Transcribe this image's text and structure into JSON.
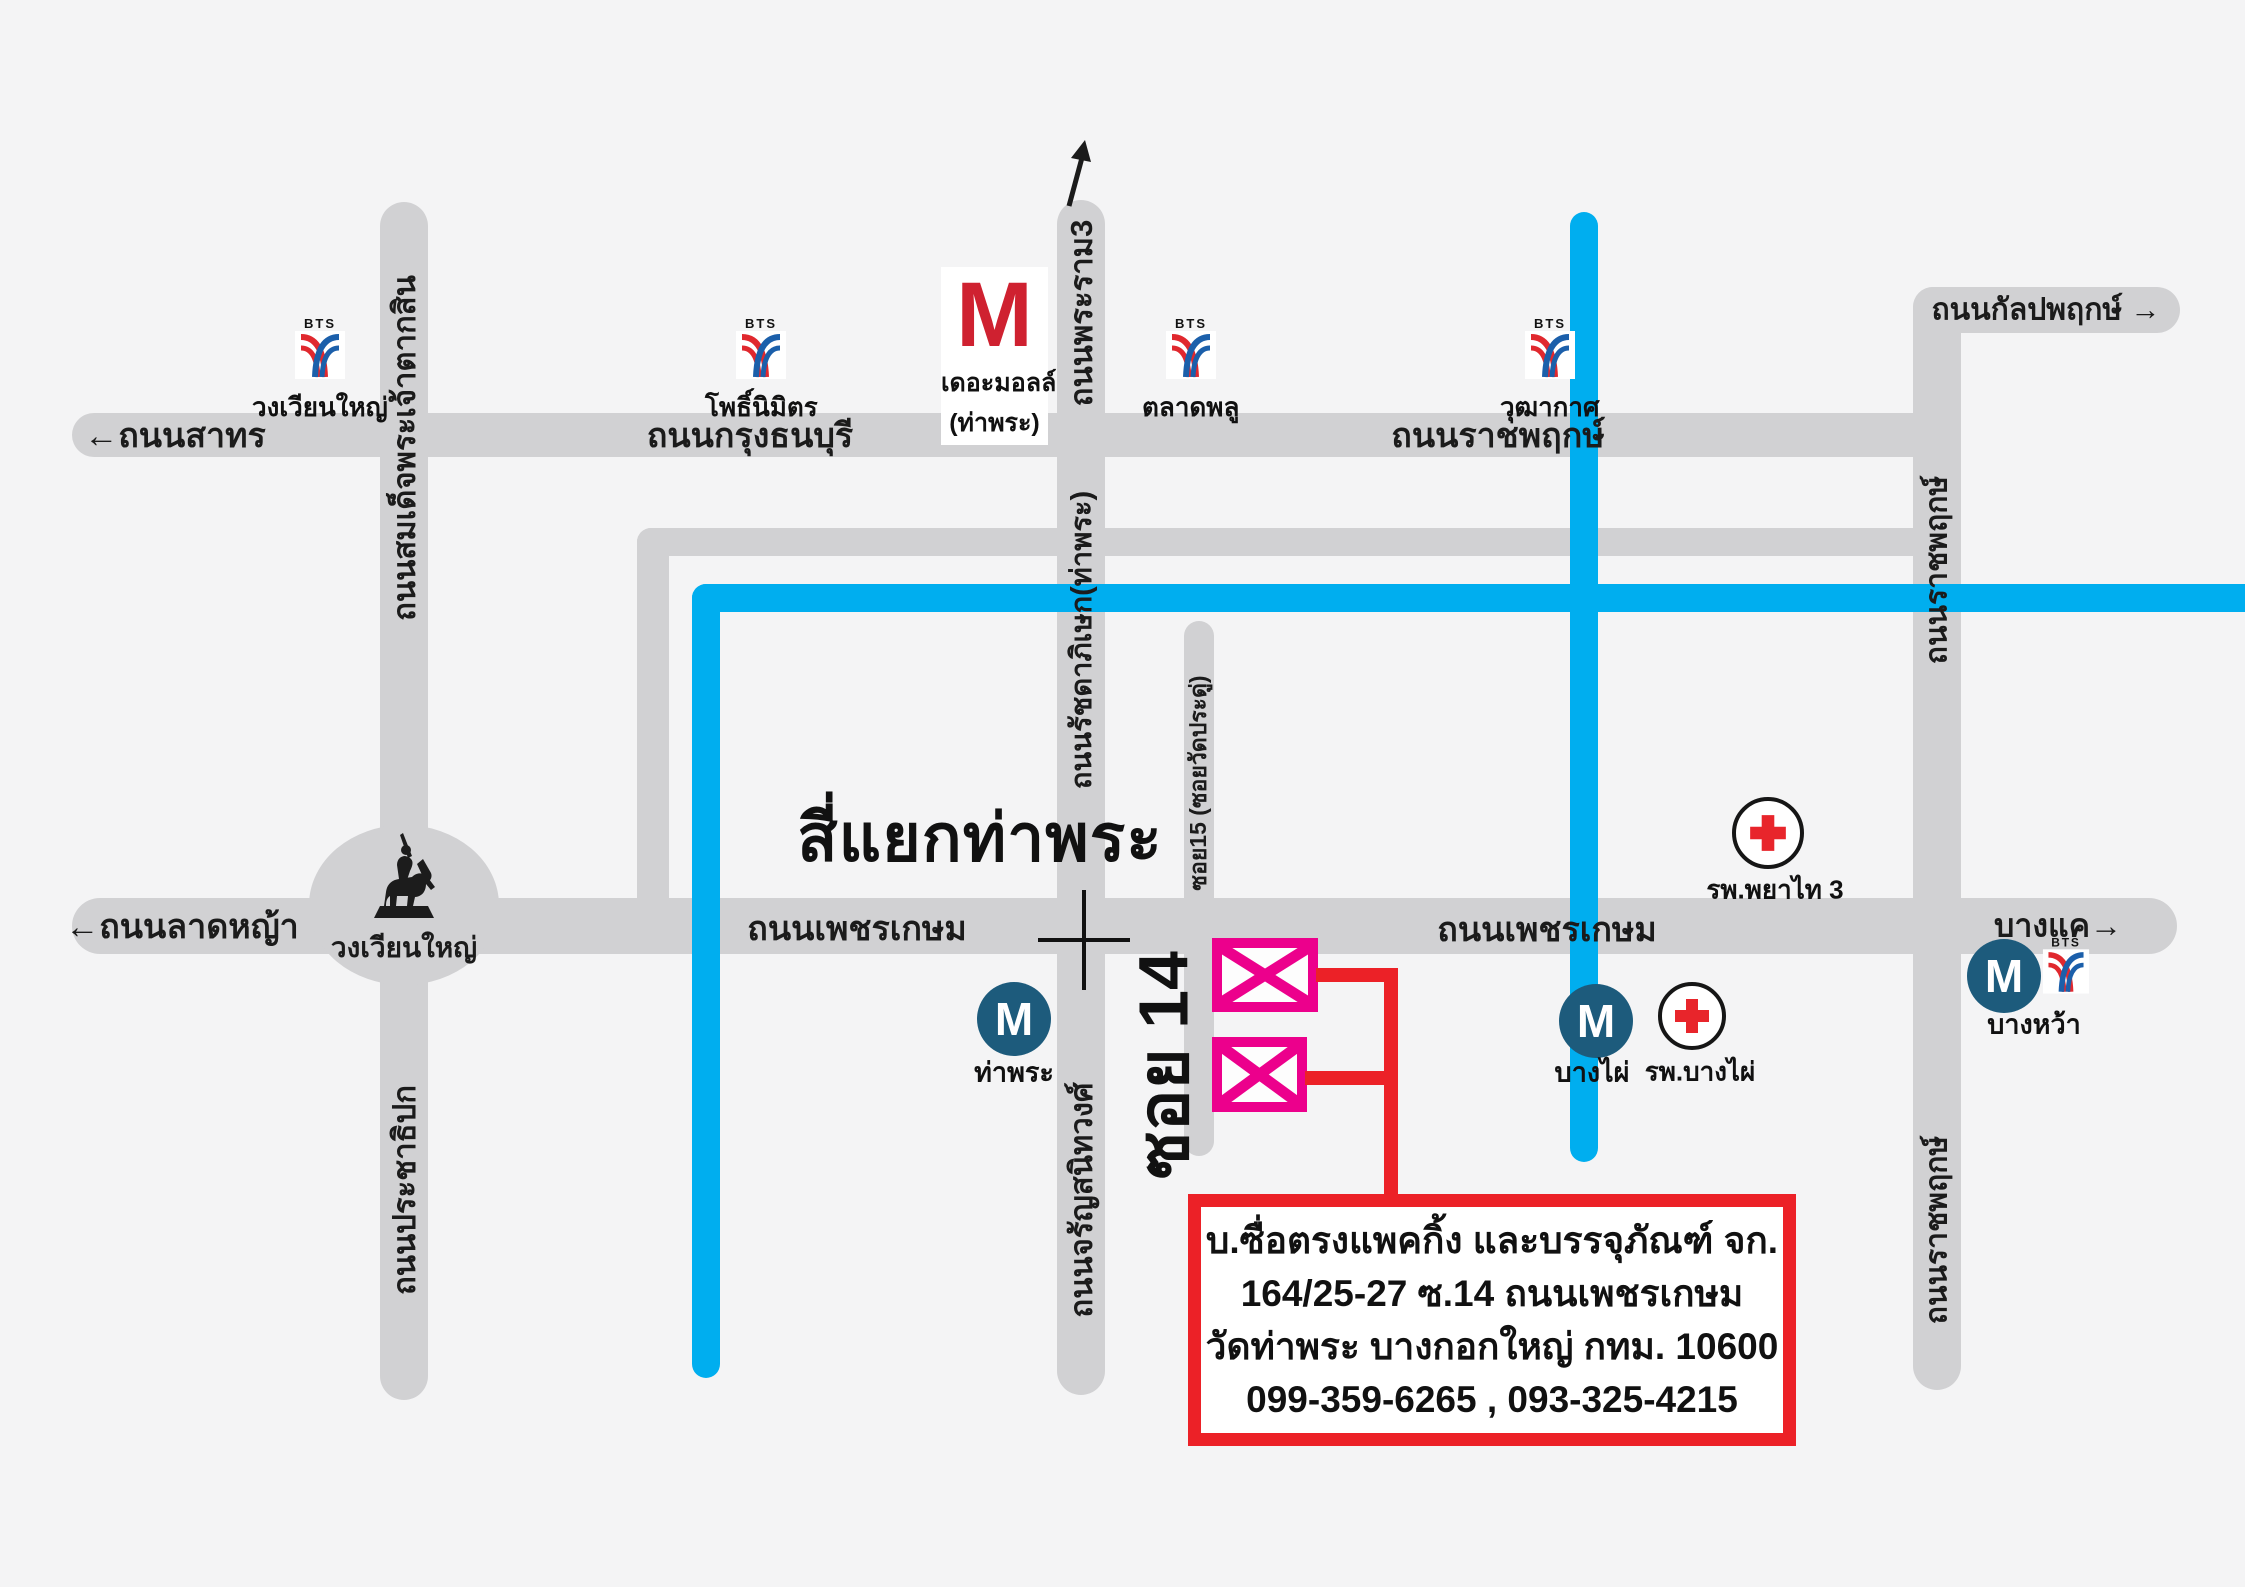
{
  "title": {
    "intersection": "สี่แยกท่าพระ"
  },
  "roads": {
    "sathorn": {
      "label": "ถนนสาทร",
      "arrow": "←"
    },
    "krung_thonburi": {
      "label": "ถนนกรุงธนบุรี"
    },
    "ratchaphruek_h": {
      "label": "ถนนราชพฤกษ์"
    },
    "kanlapaphruek": {
      "label": "ถนนกัลปพฤกษ์",
      "arrow": "→"
    },
    "lat_ya": {
      "label": "ถนนลาดหญ้า",
      "arrow": "←"
    },
    "phetkasem_west": {
      "label": "ถนนเพชรเกษม"
    },
    "phetkasem_east": {
      "label": "ถนนเพชรเกษม"
    },
    "bang_khae": {
      "label": "บางแค",
      "arrow": "→"
    },
    "taksin": {
      "label": "ถนนสมเด็จพระเจ้าตากสิน"
    },
    "prachathipok": {
      "label": "ถนนประชาธิปก"
    },
    "rama3": {
      "label": "ถนนพระราม3"
    },
    "ratchadaphisek": {
      "label": "ถนนรัชดาภิเษก(ท่าพระ)"
    },
    "charansanitwong": {
      "label": "ถนนจรัญสนิทวงศ์"
    },
    "soi15": {
      "label": "ซอย15 (ซอยวัดประดู่)"
    },
    "ratchaphruek_v_top": {
      "label": "ถนนราชพฤกษ์"
    },
    "ratchaphruek_v_bot": {
      "label": "ถนนราชพฤกษ์"
    },
    "soi14": {
      "label": "ซอย 14"
    }
  },
  "stations": {
    "bts_wongwian_yai": {
      "label": "วงเวียนใหญ่"
    },
    "bts_pho_nimit": {
      "label": "โพธิ์นิมิตร"
    },
    "bts_talat_phlu": {
      "label": "ตลาดพลู"
    },
    "bts_wutthakat": {
      "label": "วุฒากาศ"
    },
    "bts_bang_wa": {
      "label": "บางหว้า"
    },
    "mrt_tha_phra": {
      "label": "ท่าพระ"
    },
    "mrt_bang_phai": {
      "label": "บางไผ่"
    }
  },
  "places": {
    "the_mall": {
      "letter": "M",
      "name": "เดอะมอลล์",
      "branch": "(ท่าพระ)"
    },
    "wongwian_yai_circle": {
      "label": "วงเวียนใหญ่"
    },
    "hospital_phayathai": {
      "label": "รพ.พยาไท 3"
    },
    "hospital_bang_phai": {
      "label": "รพ.บางไผ่"
    }
  },
  "info_box": {
    "line1": "บ.ซื่อตรงแพคกิ้ง และบรรจุภัณฑ์ จก.",
    "line2": "164/25-27 ซ.14 ถนนเพชรเกษม",
    "line3": "วัดท่าพระ บางกอกใหญ่ กทม. 10600",
    "line4": "099-359-6265 , 093-325-4215"
  },
  "icons": {
    "bts_wordmark": "BTS",
    "mrt_letter": "M"
  },
  "colors": {
    "road": "#d1d1d3",
    "canal_blue": "#00aeef",
    "marker_pink": "#ec008c",
    "accent_red": "#ec2127",
    "mall_red": "#cf2130",
    "mrt_blue": "#1d5b7c"
  }
}
